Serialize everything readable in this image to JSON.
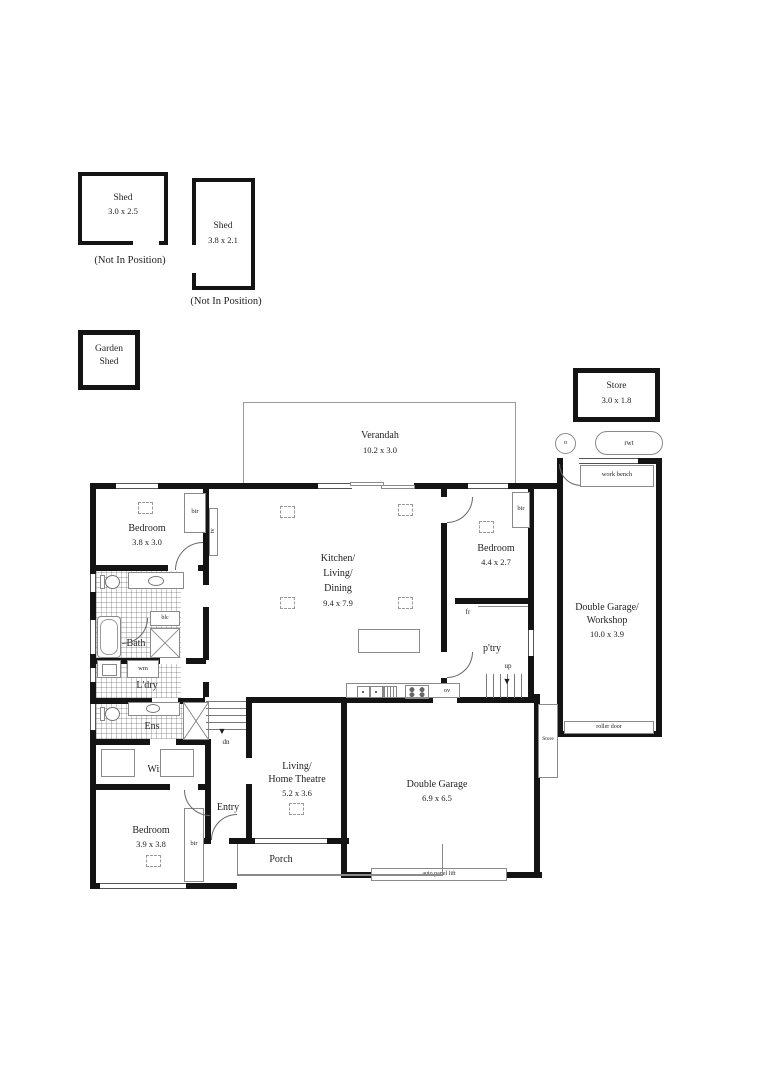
{
  "outbuildings": {
    "shed1": {
      "name": "Shed",
      "size": "3.0 x 2.5",
      "note": "(Not In Position)"
    },
    "shed2": {
      "name": "Shed",
      "size": "3.8 x 2.1",
      "note": "(Not In Position)"
    },
    "garden_shed": {
      "line1": "Garden",
      "line2": "Shed"
    },
    "store_top": {
      "name": "Store",
      "size": "3.0 x 1.8"
    },
    "rwt_label": "rwt",
    "vent_label": "o"
  },
  "rooms": {
    "verandah": {
      "name": "Verandah",
      "size": "10.2 x 3.0"
    },
    "kitchen": {
      "line1": "Kitchen/",
      "line2": "Living/",
      "line3": "Dining",
      "size": "9.4 x 7.9"
    },
    "bedroom1": {
      "name": "Bedroom",
      "size": "3.8 x 3.0"
    },
    "bedroom2": {
      "name": "Bedroom",
      "size": "4.4 x 2.7"
    },
    "bedroom3": {
      "name": "Bedroom",
      "size": "3.9 x 3.8"
    },
    "bath": {
      "name": "Bath"
    },
    "ldry": {
      "name": "L'dry"
    },
    "ens": {
      "name": "Ens"
    },
    "wir": {
      "name": "Wir"
    },
    "entry": {
      "name": "Entry"
    },
    "pantry": {
      "name": "p'try"
    },
    "living": {
      "line1": "Living/",
      "line2": "Home Theatre",
      "size": "5.2 x 3.6"
    },
    "garage": {
      "name": "Double Garage",
      "size": "6.9 x 6.5"
    },
    "workshop": {
      "line1": "Double Garage/",
      "line2": "Workshop",
      "size": "10.0 x 3.9"
    },
    "store_side": {
      "name": "Store"
    },
    "porch": {
      "name": "Porch"
    }
  },
  "fixtures": {
    "bir": "bir",
    "tv": "tv",
    "blc": "blc",
    "wm": "wm",
    "fr": "fr",
    "ov": "ov",
    "up": "up",
    "dn": "dn",
    "work_bench": "work bench",
    "roller_door": "roller door",
    "auto_panel_lift": "auto panel lift"
  },
  "colors": {
    "wall": "#141414",
    "line": "#8a8a8a",
    "text": "#1f1f1f",
    "background": "#ffffff"
  }
}
